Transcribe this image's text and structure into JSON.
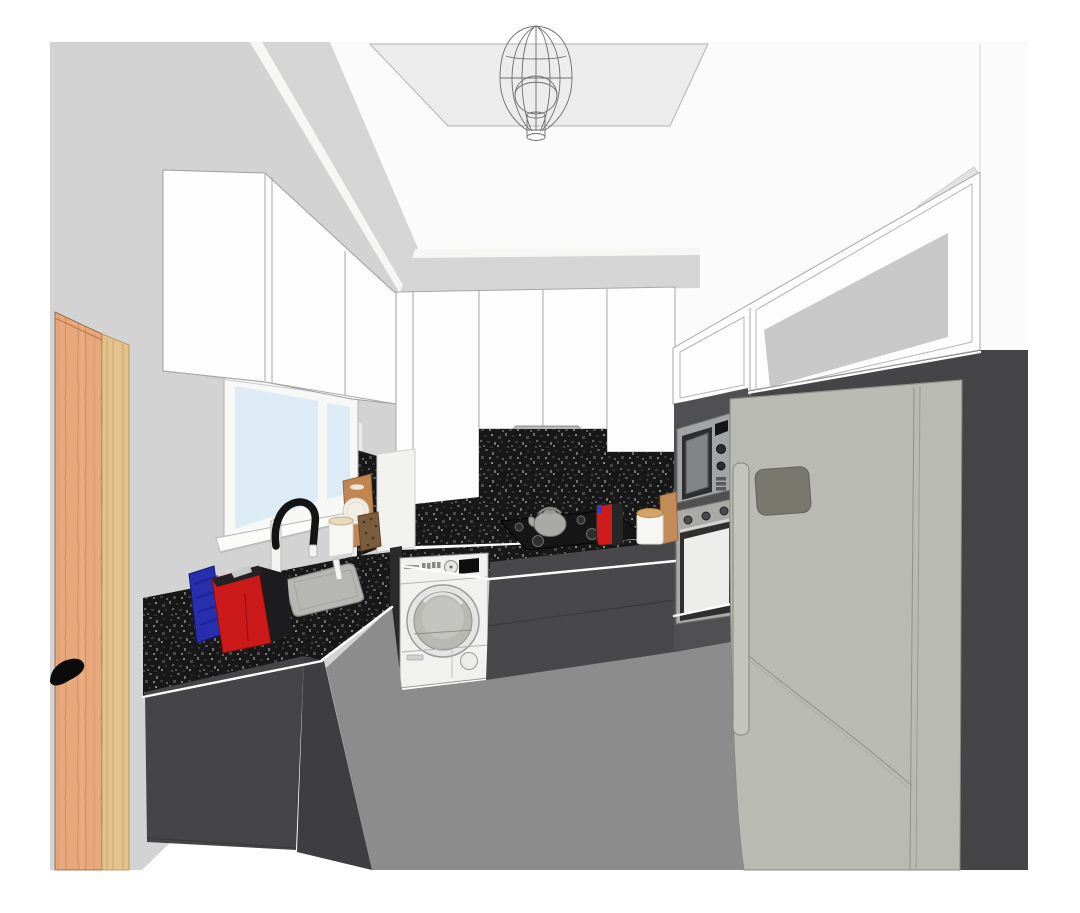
{
  "meta": {
    "view": "3d-kitchen-interior-render",
    "style": "sketchup-like perspective, U-shaped kitchen"
  },
  "scene": {
    "objects": [
      {
        "name": "pendant-light",
        "desc": "wireframe teardrop chandelier on recessed ceiling panel"
      },
      {
        "name": "upper-cabinets-left",
        "desc": "white flat-front wall cabinets on left wall"
      },
      {
        "name": "back-wall-cabinets",
        "desc": "white flat-front wall cabinets on back wall"
      },
      {
        "name": "upper-cabinets-right",
        "desc": "white cabinets with frosted glass band on right wall"
      },
      {
        "name": "window",
        "desc": "two-pane window with pale blue glass on left wall"
      },
      {
        "name": "faucet",
        "desc": "black gooseneck mixer tap with white body"
      },
      {
        "name": "kitchen-sink",
        "desc": "gray undermount sink in granite top"
      },
      {
        "name": "coffee-machine",
        "desc": "red capsule coffee machine on left counter"
      },
      {
        "name": "blue-towel",
        "desc": "blue textured item beside coffee machine"
      },
      {
        "name": "paper-bag",
        "desc": "kraft bag with plate and coffee pouch"
      },
      {
        "name": "storage-canister",
        "desc": "white canisters with wooden lids"
      },
      {
        "name": "washing-machine",
        "desc": "white front-load washer under back counter"
      },
      {
        "name": "gas-hob",
        "desc": "black 5-burner gas hob with gray kettle"
      },
      {
        "name": "range-hood",
        "desc": "stainless chimney hood under cabinets"
      },
      {
        "name": "small-coffee-machine",
        "desc": "small red espresso machine on back counter"
      },
      {
        "name": "built-in-microwave",
        "desc": "stainless microwave in tall unit"
      },
      {
        "name": "built-in-oven",
        "desc": "stainless single oven in tall unit"
      },
      {
        "name": "refrigerator",
        "desc": "large gray free-standing fridge freezer"
      },
      {
        "name": "wooden-door",
        "desc": "open wooden door with black lever handle, left foreground"
      },
      {
        "name": "granite-counters",
        "desc": "black speckled granite worktops and backsplash"
      }
    ]
  },
  "colors": {
    "margin": "#ffffff",
    "wall": "#d2d3d2",
    "ceiling": "#fafbfa",
    "ceiling_panel": "#ececec",
    "soffit": "#d5d5d6",
    "fascia": "#f6f6f5",
    "triangle": "#e2e2e2",
    "cabinet_white": "#fdfdfd",
    "corner_column": "#f1f1f0",
    "glass_frost": "#c8c8c8",
    "granite_base": "#181818",
    "window_glass": "#dcebf5",
    "window_frame": "#f7f7f6",
    "window_sill": "#fbfbfa",
    "catchlight": "#eaeaea",
    "base_cabinet": "#454547",
    "base_cabinet_side": "#3e3e40",
    "base_cabinet_back": "#48484a",
    "dark_gap": "#2a2a2a",
    "floor": "#8c8c8c",
    "right_wall": "#454548",
    "unit_face": "#505052",
    "microwave_frame": "#a3a4a6",
    "microwave_window": "#2e2e30",
    "microwave_screen": "#828486",
    "microwave_display": "#151515",
    "oven_frame": "#a9aaa6",
    "oven_glass_frame": "#2f2f2f",
    "oven_glass": "#ededeb",
    "washer_body": "#f1f1ef",
    "washer_ring": "#e4e4e2",
    "washer_door": "#b8b9b3",
    "washer_door_inner": "#c3c4bf",
    "washer_display": "#0e0e0e",
    "hood_body": "#b5b5b3",
    "hood_band": "#9c9c9a",
    "hob": "#161617",
    "burner": "#2f2f30",
    "kettle": "#a9a9a5",
    "fridge_body": "#b9bbb3",
    "fridge_handle": "#c3c5bd",
    "fridge_panel": "#79786f",
    "red_appliance": "#cc1a1a",
    "red_appliance_dark": "#1c1c1e",
    "red_appliance_lid": "#232325",
    "small_red": "#cf1b1b",
    "small_red_dark": "#27272a",
    "blue_item": "#282fae",
    "canister": "#f6f6f3",
    "canister_lid_wood": "#d8a266",
    "canister_lid_cream": "#e7d9bb",
    "board_wood": "#c28b57",
    "bag": "#c08550",
    "bag_plate": "#f2eee6",
    "bag_pouch": "#7b5c3c",
    "sink": "#b6b7b3",
    "faucet_black": "#141414",
    "faucet_white": "#f3f3f1",
    "door_wood": "#e8a87c",
    "door_trim": "#e4c28e",
    "door_handle": "#0b0b0b",
    "chandelier_wire": "#5f5f5f",
    "highlight": "#ffffff"
  }
}
